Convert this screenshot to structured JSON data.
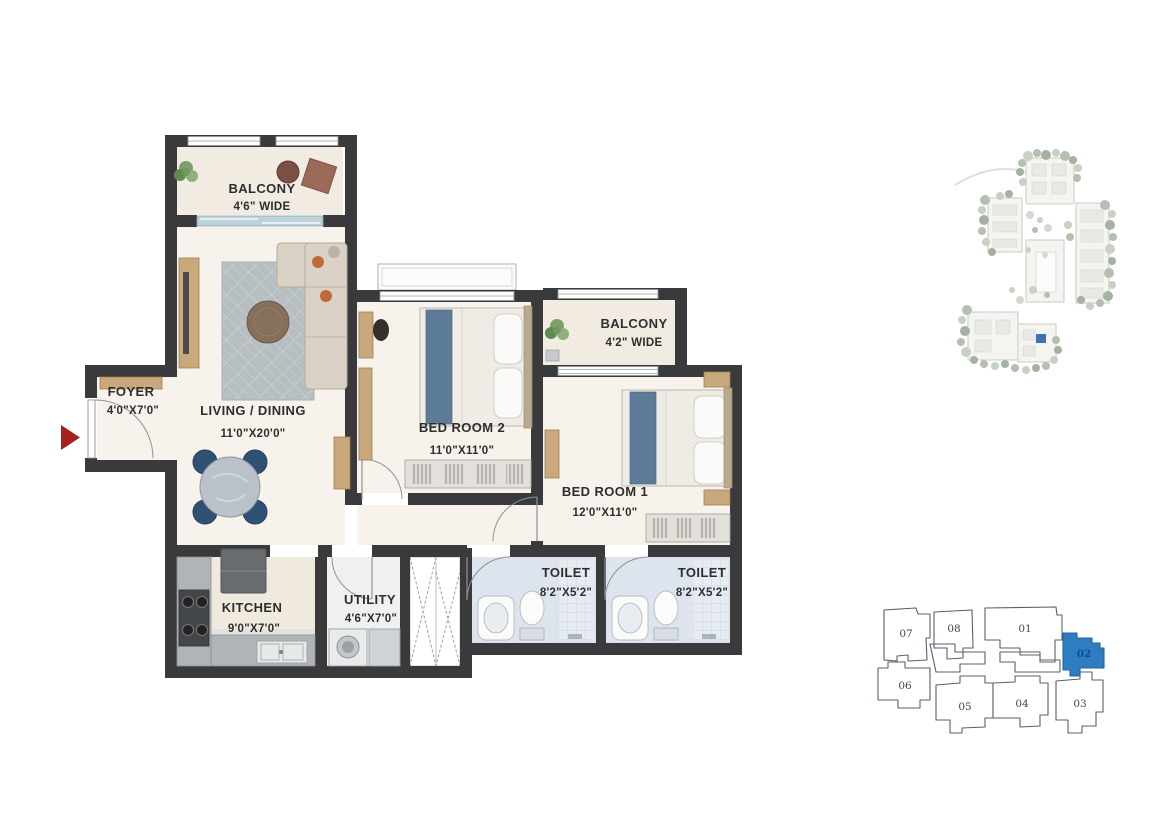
{
  "floor_plan": {
    "wall_color": "#3a3a3c",
    "entry_arrow_color": "#a6201f",
    "rooms": {
      "balcony1": {
        "name": "BALCONY",
        "dim": "4'6\" WIDE"
      },
      "living": {
        "name": "LIVING / DINING",
        "dim": "11'0\"X20'0\""
      },
      "foyer": {
        "name": "FOYER",
        "dim": "4'0\"X7'0\""
      },
      "bedroom2": {
        "name": "BED ROOM 2",
        "dim": "11'0\"X11'0\""
      },
      "balcony2": {
        "name": "BALCONY",
        "dim": "4'2\" WIDE"
      },
      "bedroom1": {
        "name": "BED ROOM 1",
        "dim": "12'0\"X11'0\""
      },
      "kitchen": {
        "name": "KITCHEN",
        "dim": "9'0\"X7'0\""
      },
      "utility": {
        "name": "UTILITY",
        "dim": "4'6\"X7'0\""
      },
      "toilet1": {
        "name": "TOILET",
        "dim": "8'2\"X5'2\""
      },
      "toilet2": {
        "name": "TOILET",
        "dim": "8'2\"X5'2\""
      }
    }
  },
  "key_plan": {
    "highlighted_unit": "02",
    "highlight_color": "#2e7cc2",
    "units": {
      "u01": "01",
      "u02": "02",
      "u03": "03",
      "u04": "04",
      "u05": "05",
      "u06": "06",
      "u07": "07",
      "u08": "08"
    }
  },
  "site_map": {
    "marker_color": "#3f72b4"
  }
}
